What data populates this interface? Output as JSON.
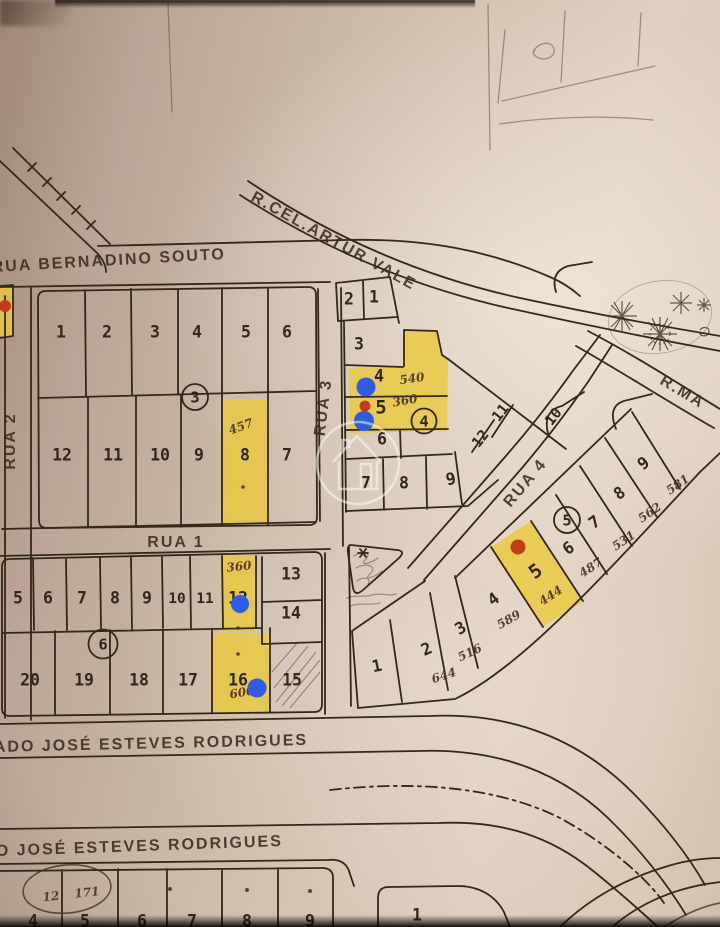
{
  "map": {
    "streets": {
      "bernadino_souto": "RUA BERNADINO SOUTO",
      "artur_vale": "R.CEL.ARTUR VALE",
      "rua_1": "RUA 1",
      "rua_2": "RUA 2",
      "rua_3": "RUA 3",
      "rua_4": "RUA 4",
      "r_ma": "R.MA",
      "esteves_upper": "ADO JOSÉ ESTEVES RODRIGUES",
      "esteves_lower": "O JOSÉ ESTEVES RODRIGUES"
    },
    "block_numbers": {
      "block3": "3",
      "block4": "4",
      "block5": "5",
      "block6": "6"
    },
    "lots": {
      "block3_top": [
        "1",
        "2",
        "3",
        "4",
        "5",
        "6"
      ],
      "block3_bottom": [
        "12",
        "11",
        "10",
        "9",
        "8",
        "7"
      ],
      "block4_pair": [
        "2",
        "1"
      ],
      "block4_col": [
        "3",
        "4",
        "5",
        "6"
      ],
      "block4_row": [
        "7",
        "8",
        "9"
      ],
      "block4_diag": [
        "12",
        "11",
        "10"
      ],
      "block5": [
        "1",
        "2",
        "3",
        "4",
        "5",
        "6",
        "7",
        "8",
        "9"
      ],
      "block6_top": [
        "5",
        "6",
        "7",
        "8",
        "9",
        "10",
        "11",
        "12"
      ],
      "block6_right": [
        "13",
        "14"
      ],
      "block6_bottom": [
        "20",
        "19",
        "18",
        "17",
        "16",
        "15"
      ],
      "bottom_block": [
        "4",
        "5",
        "6",
        "7",
        "8",
        "9"
      ],
      "bottom_block_right": "1"
    },
    "handwritten": {
      "lot8_area": "457",
      "lot4_area": "540",
      "lot5_area": "360",
      "lot12_area": "360",
      "lot16_area": "600",
      "block5_areas": [
        "644",
        "516",
        "589",
        "444",
        "487",
        "531",
        "562",
        "581"
      ],
      "corner_ref_left": "12",
      "corner_ref_right": "171"
    },
    "markers": {
      "highlight_color": "#eac93a",
      "pin_blue": "#2e5be8",
      "pin_red": "#c23d17",
      "ink": "#342818",
      "watermark": "house-in-circle"
    }
  }
}
